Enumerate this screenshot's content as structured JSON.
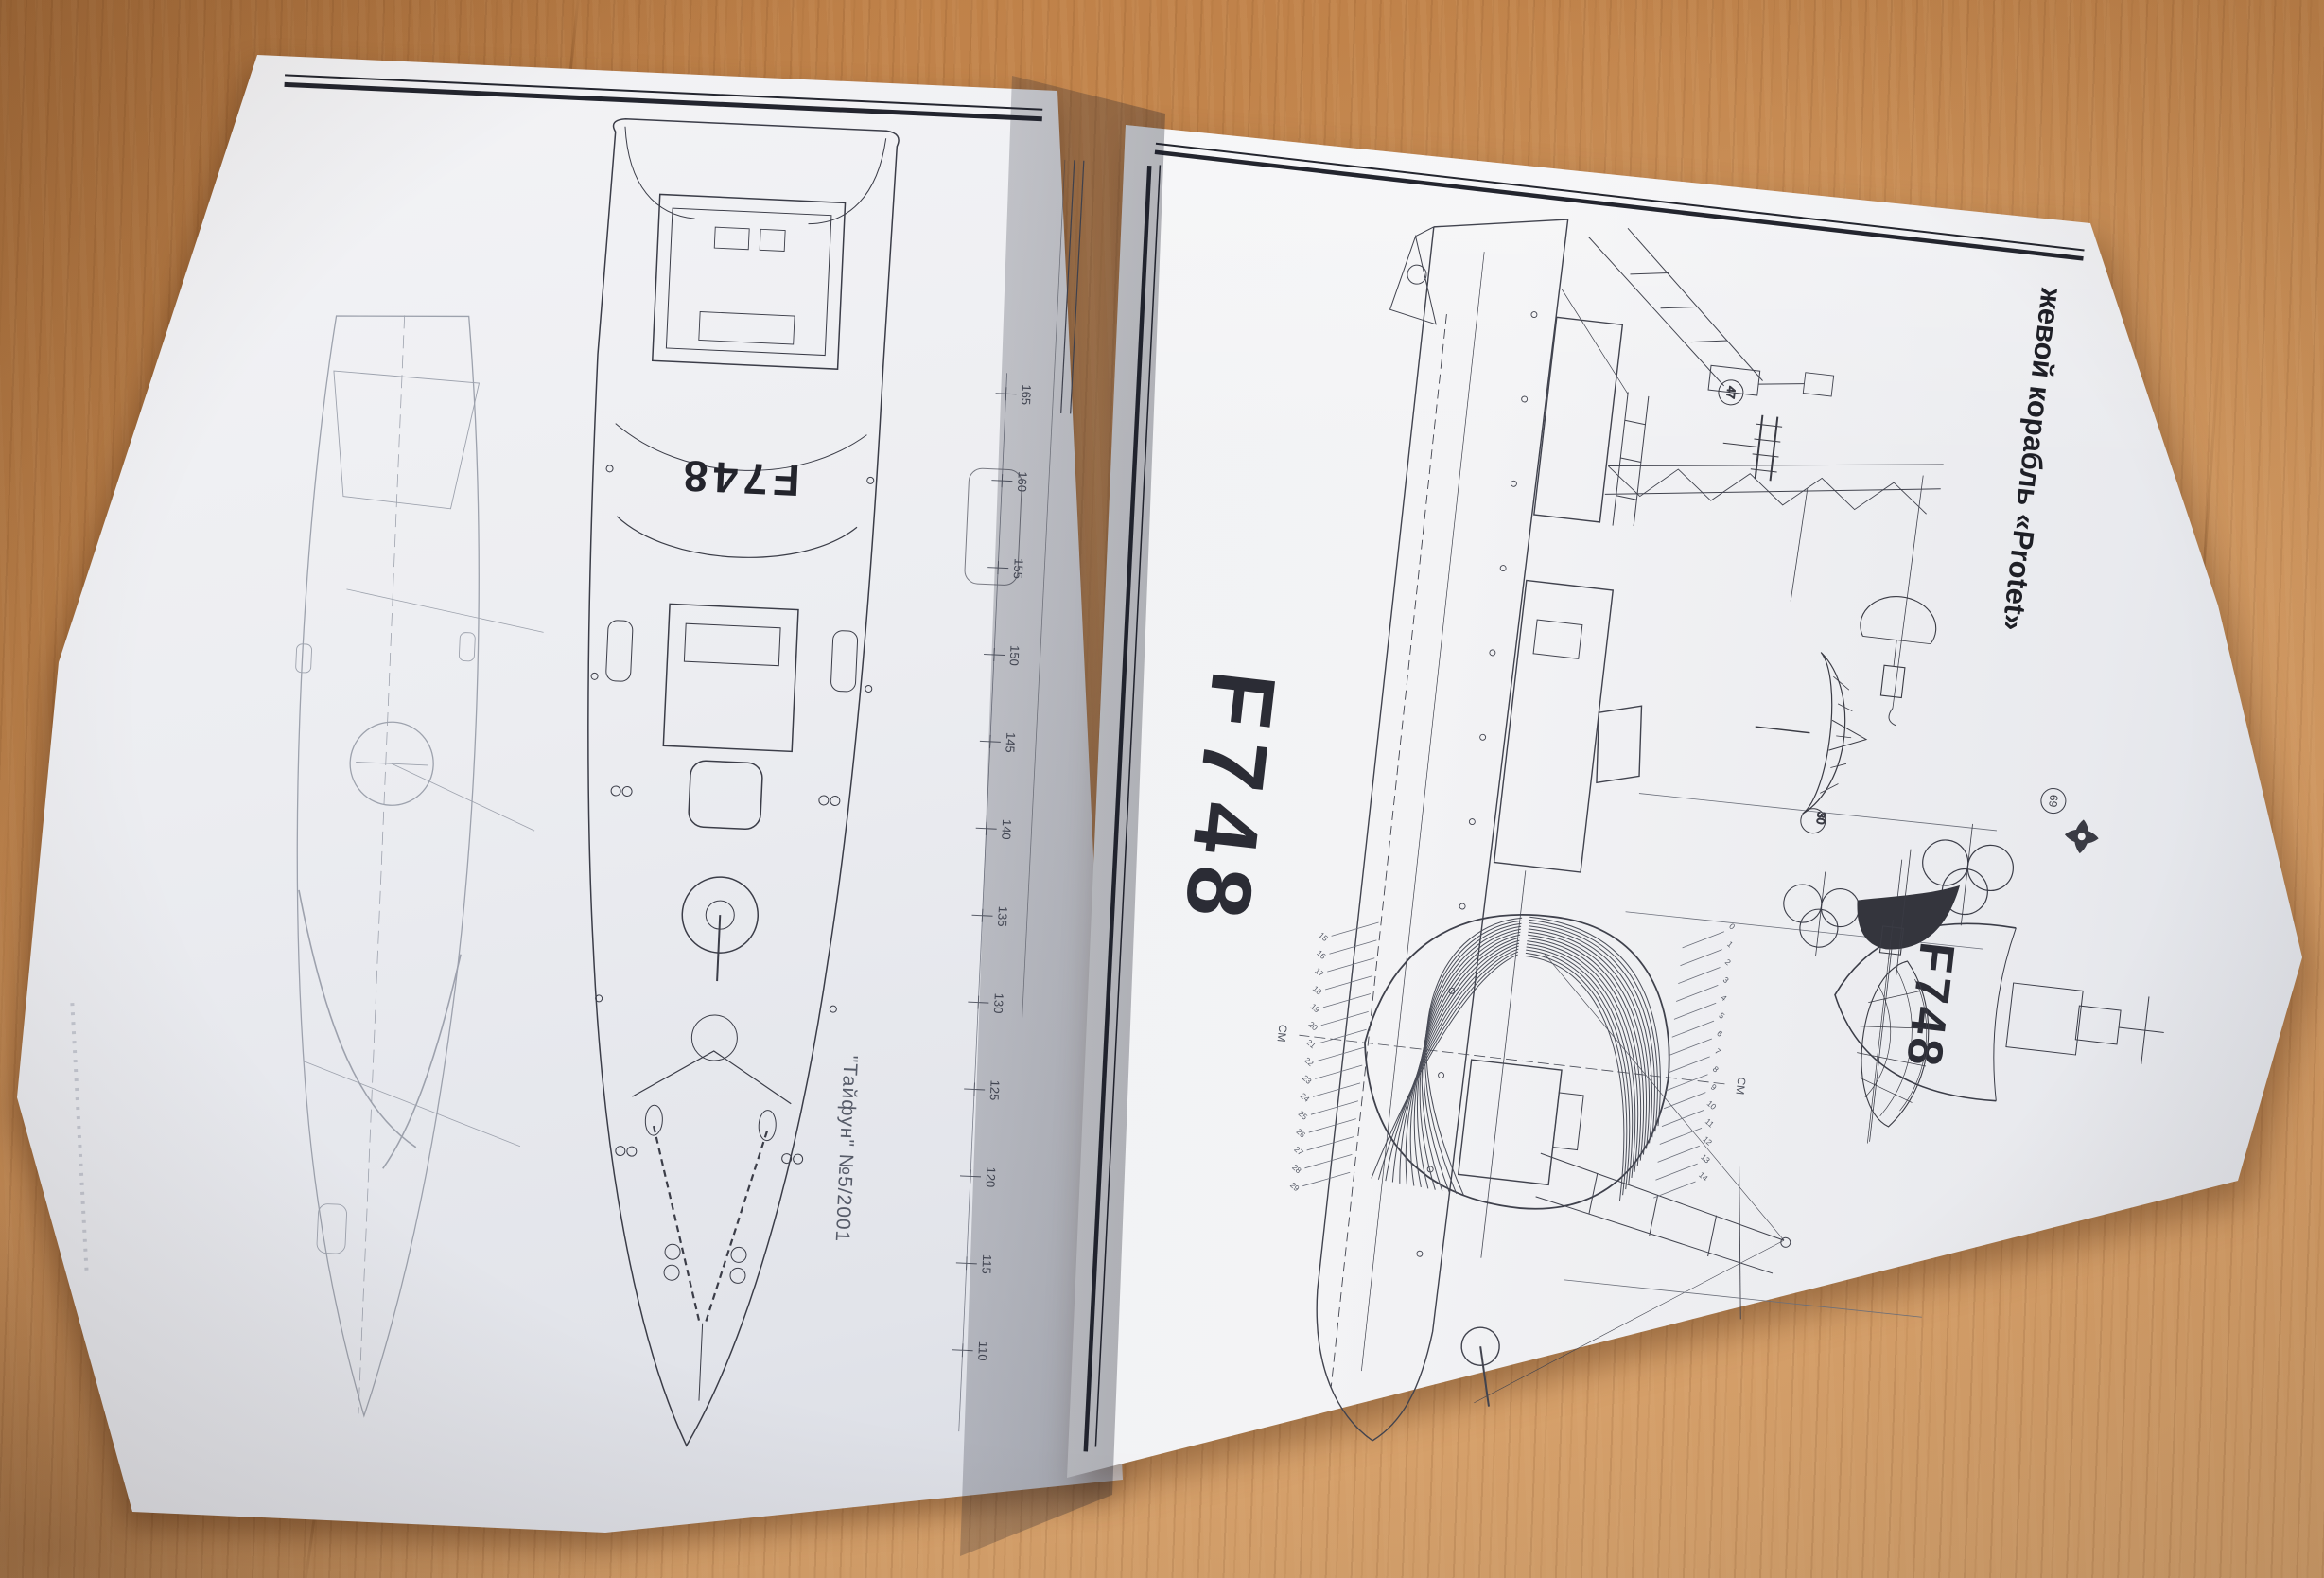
{
  "publication": {
    "issue_caption": "\"Тайфун\" №5/2001",
    "page_title_vertical": "жевой корабль «Protet»"
  },
  "ship": {
    "hull_number_deck": "F748",
    "hull_number_profile": "F748",
    "hull_number_bow": "F748"
  },
  "left_page": {
    "frame_ticks": [
      "165",
      "160",
      "155",
      "150",
      "145",
      "140",
      "135",
      "130",
      "125",
      "120",
      "115",
      "110"
    ]
  },
  "right_page": {
    "body_plan": {
      "upper_stations": [
        "0",
        "1",
        "2",
        "3",
        "4",
        "5",
        "6",
        "7",
        "8",
        "9",
        "10",
        "11",
        "12",
        "13",
        "14"
      ],
      "lower_stations": [
        "15",
        "16",
        "17",
        "18",
        "19",
        "20",
        "21",
        "22",
        "23",
        "24",
        "25",
        "26",
        "27",
        "28",
        "29"
      ],
      "axis_label_top": "СМ",
      "axis_label_bottom": "СМ"
    },
    "detail_markers": [
      "47",
      "30",
      "69"
    ]
  },
  "colors": {
    "wood": "#c98c52",
    "paper": "#f1f2f4",
    "ink": "#2b2d37",
    "pencil": "#959aa6"
  }
}
